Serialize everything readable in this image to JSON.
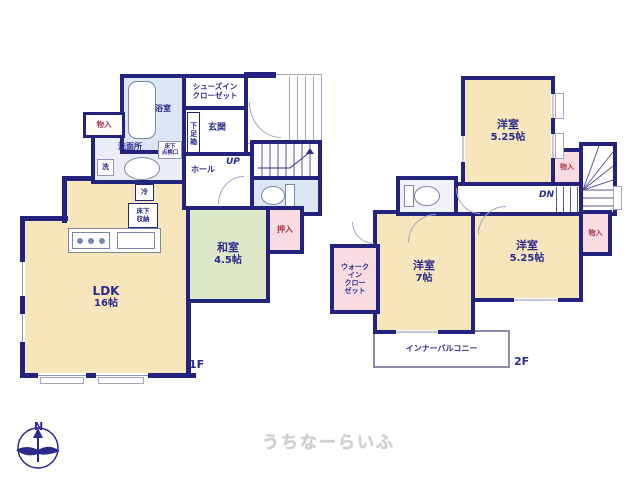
{
  "watermark": "うちなーらいふ",
  "compass": {
    "north": "N"
  },
  "colors": {
    "wall": "#23237e",
    "room_cream": "#f7e6bc",
    "tatami_green": "#dde8c8",
    "closet_pink": "#f8dce2",
    "water_blue": "#dde6f4",
    "label_navy": "#2b2b8c",
    "closet_label_red": "#a8394a",
    "watermark_gray": "#cfcfcf"
  },
  "floor1": {
    "label": "1F",
    "ldk": {
      "name": "LDK",
      "size": "16帖"
    },
    "washitsu": {
      "name": "和室",
      "size": "4.5帖"
    },
    "bathroom": "浴室",
    "shoes_closet_lines": [
      "シューズイン",
      "クローゼット"
    ],
    "genkan": "玄関",
    "shoe_box": "下足箱",
    "storage": "物入",
    "washroom": "洗面所",
    "washer": "洗",
    "hall": "ホール",
    "up": "UP",
    "fridge": "冷",
    "underfloor_storage_lines": [
      "床下",
      "収納"
    ],
    "inspection_hatch_lines": [
      "床下",
      "点検口"
    ],
    "oshiire": "押入"
  },
  "floor2": {
    "label": "2F",
    "bedroom_top": {
      "name": "洋室",
      "size": "5.25帖"
    },
    "bedroom_left": {
      "name": "洋室",
      "size": "7帖"
    },
    "bedroom_right": {
      "name": "洋室",
      "size": "5.25帖"
    },
    "storage_top": "物入",
    "storage_right": "物入",
    "walk_in_closet_lines": [
      "ウォーク",
      "イン",
      "クロー",
      "ゼット"
    ],
    "down": "DN",
    "inner_balcony": "インナーバルコニー"
  }
}
